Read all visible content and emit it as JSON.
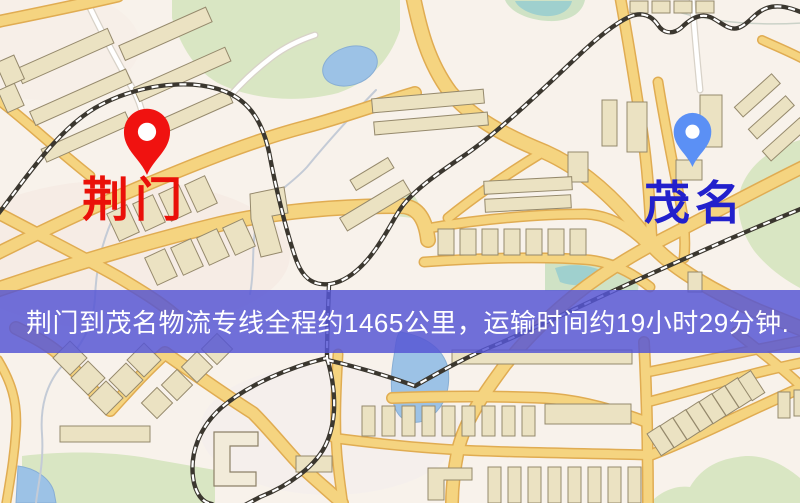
{
  "banner": {
    "text": "荆门到茂名物流专线全程约1465公里，运输时间约19小时29分钟.",
    "background_color": "#5656D4",
    "text_color": "#FFFFFF"
  },
  "route": {
    "origin": {
      "name": "荆门",
      "marker_color": "#F01210",
      "label_color": "#EA1009"
    },
    "destination": {
      "name": "茂名",
      "marker_color": "#5B90F5",
      "label_color": "#2220CC"
    },
    "distance_text": "约1465公里",
    "duration_text": "约19小时29分钟"
  },
  "map": {
    "type": "street-map",
    "palette": {
      "background": "#F8F2EB",
      "road_fill": "#F5D480",
      "road_casing": "#E0AC52",
      "park": "#D9E6C3",
      "water": "#9CC2E6",
      "building_fill": "#EBE2C2",
      "building_stroke": "#95896C",
      "railway": "#3B372F"
    }
  }
}
